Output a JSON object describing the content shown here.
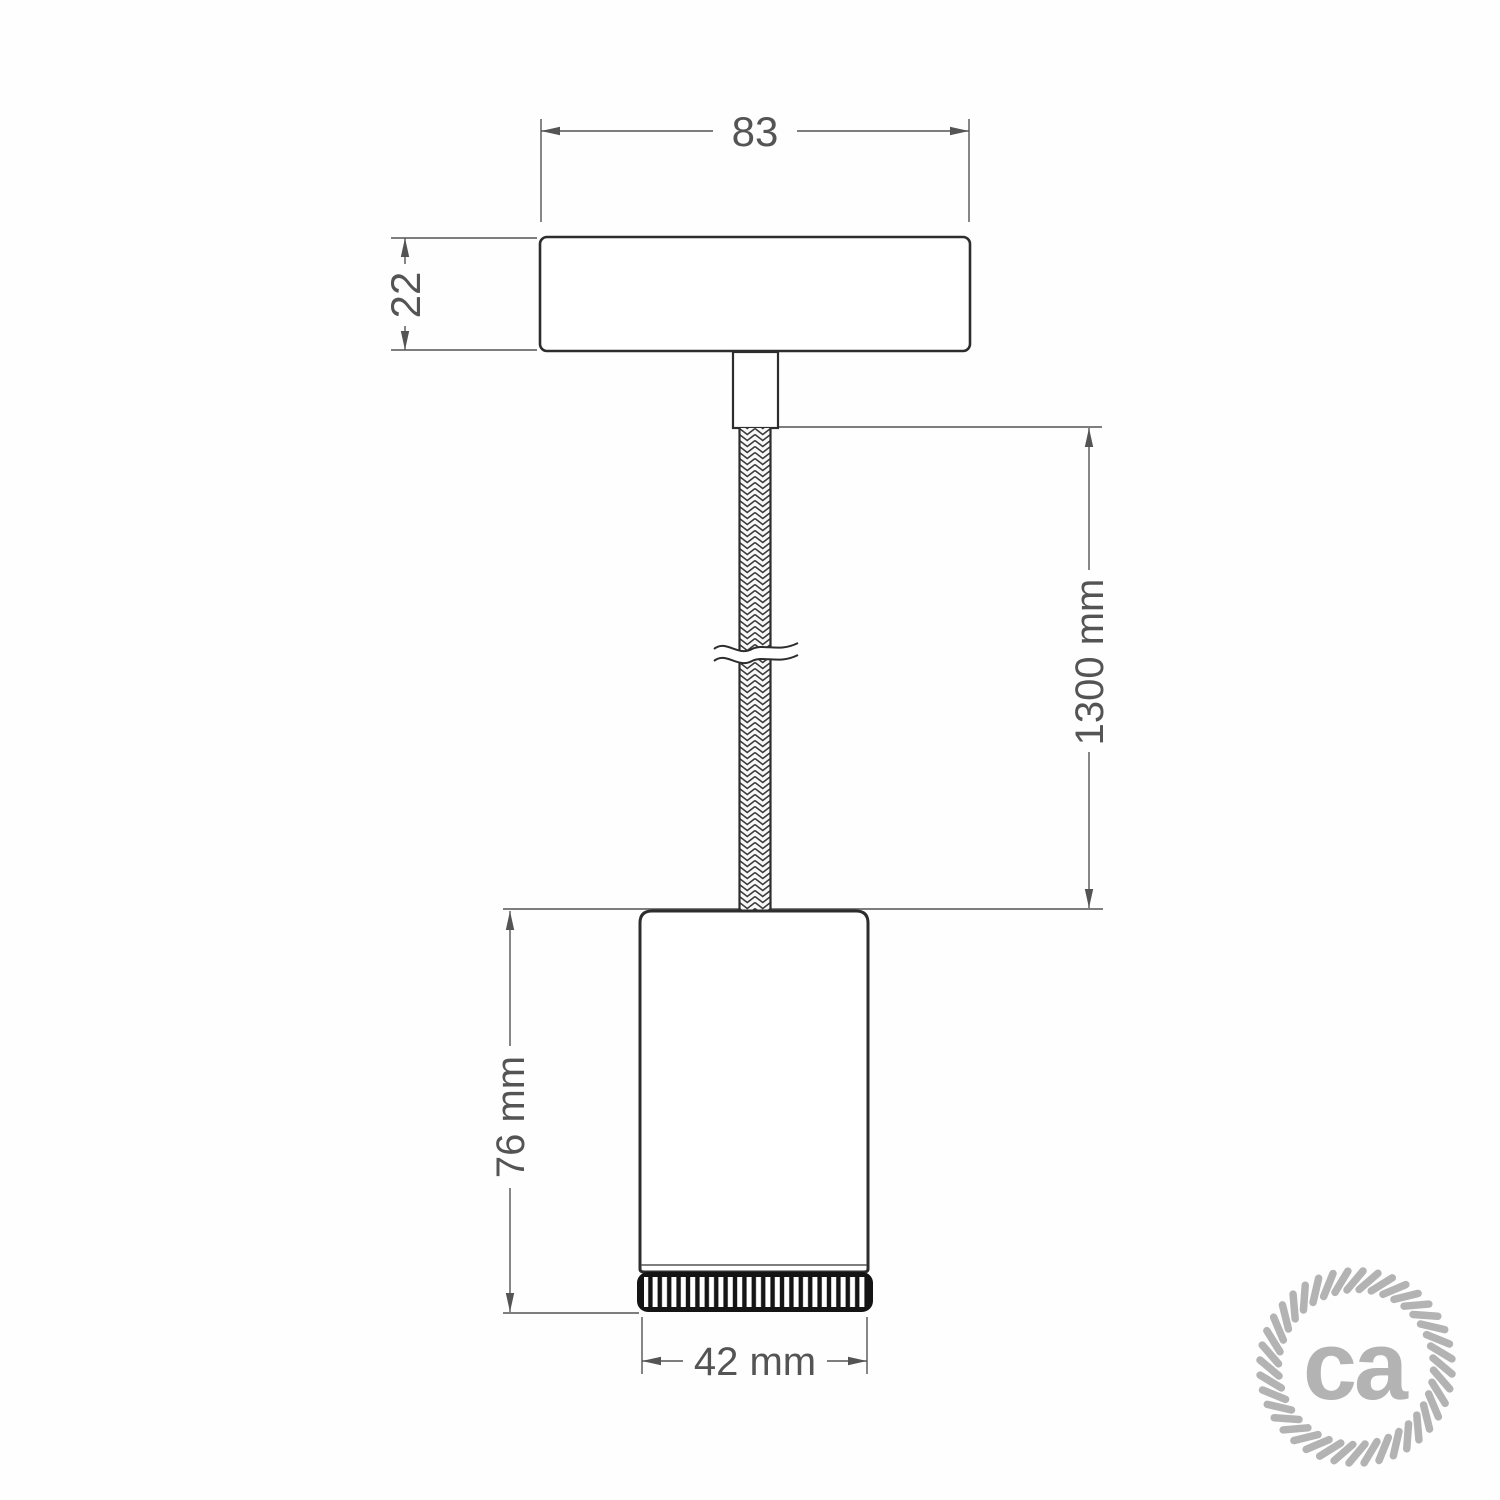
{
  "diagram": {
    "dims": {
      "canopy_width": "83",
      "canopy_height": "22",
      "cable_length": "1300 mm",
      "spot_height": "76 mm",
      "spot_diameter": "42 mm"
    },
    "logo": {
      "text": "ca",
      "color": "#b3b3b3"
    },
    "colors": {
      "outline": "#2d2d2d",
      "dimension_lines": "#545454",
      "background": "#fefefe"
    }
  }
}
